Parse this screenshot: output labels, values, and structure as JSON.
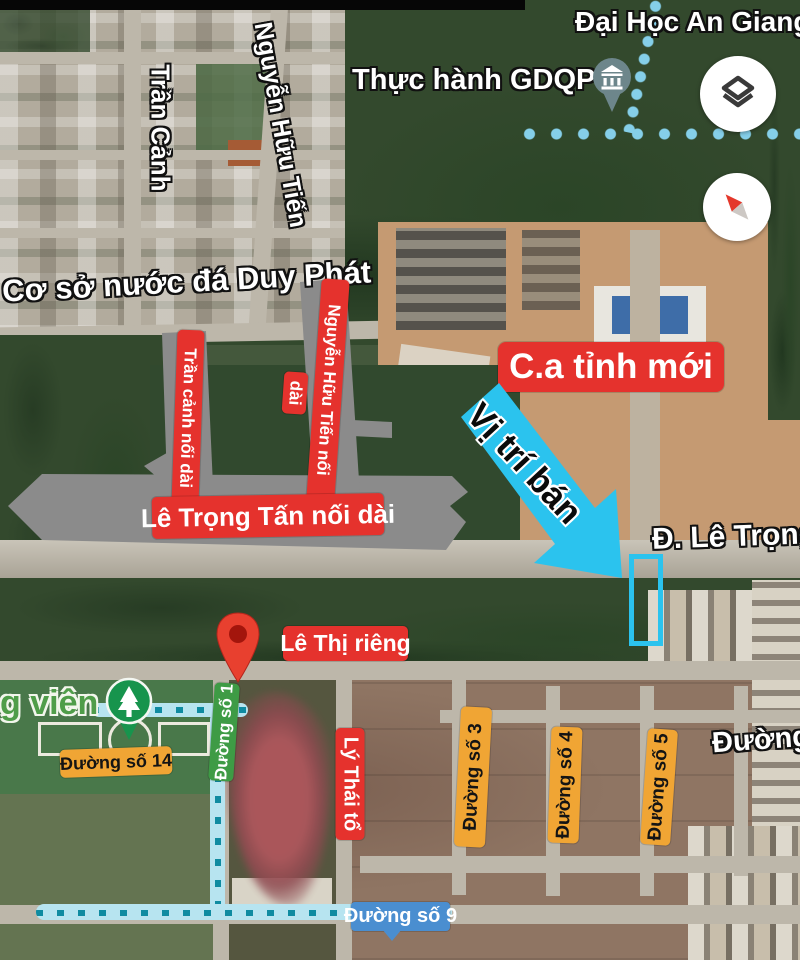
{
  "map": {
    "place_labels": {
      "university": "Đại Học An Giang",
      "gdqp": "Thực hành GDQP",
      "ice_factory": "Cơ sở nước đá Duy Phát",
      "park_partial": "g viên",
      "main_road": "Đ. Lê Trọng",
      "right_road_partial": "Đường"
    },
    "street_names": {
      "tran_canh": "Trần Cảnh",
      "nguyen_huu_tien": "Nguyễn Hữu Tiến"
    },
    "red_annotations": {
      "tran_canh_ext": "Trần cảnh nối dài",
      "nguyen_huu_tien_ext": "Nguyễn Hữu Tiến nối",
      "nguyen_huu_tien_ext2": "dài",
      "le_trong_tan_ext": "Lê Trọng Tấn nối dài",
      "new_police_hq": "C.a tỉnh mới",
      "le_thi_rieng": "Lê Thị riêng",
      "ly_thai_to": "Lý Thái tổ"
    },
    "street_signs": {
      "no1": "Đường số 1",
      "no14": "Đường số 14",
      "no3": "Đường số 3",
      "no4": "Đường số 4",
      "no5": "Đường số 5",
      "no9": "Đường số 9"
    },
    "callout": {
      "sale_position": "Vị trí bán"
    },
    "icons": {
      "layers": "layers-icon",
      "compass": "compass-icon",
      "school_pin": "school-pin-icon",
      "park_pin": "park-tree-icon",
      "marker": "red-map-pin"
    },
    "colors": {
      "annotation_red": "#e5322d",
      "sign_orange": "#f0a534",
      "sign_green": "#3e9b45",
      "sign_blue": "#4a8ed0",
      "highlight_cyan": "#2bc3ee",
      "route_cyan": "#b7e4f0",
      "route_dash": "#0f8ba1",
      "planned_road_gray": "#8b8b8b"
    }
  }
}
